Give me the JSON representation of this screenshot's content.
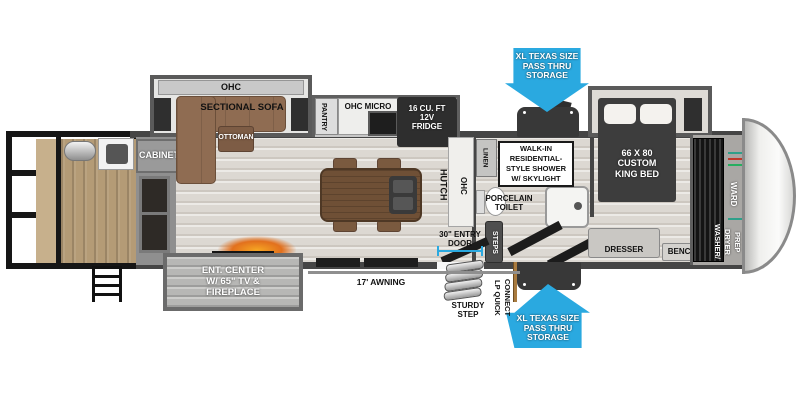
{
  "colors": {
    "arrow_blue": "#2aa9e0",
    "wall_gray": "#454545",
    "sofa_brown": "#8f6c52",
    "island_brown": "#6f5036",
    "bed_dark": "#3d3d3d",
    "garage_wood": "#b49b76",
    "fireplace_orange": "#e8941a"
  },
  "labels": {
    "ohc_top": "OHC",
    "sectional_sofa": "SECTIONAL SOFA",
    "ottoman": "OTTOMAN",
    "cabinet": "CABINET",
    "pantry": "PANTRY",
    "ohc_micro": "OHC MICRO",
    "fridge": "16 CU. FT\n12V\nFRIDGE",
    "pass_thru_top": "XL TEXAS SIZE\nPASS THRU\nSTORAGE",
    "shower": "WALK-IN\nRESIDENTIAL-\nSTYLE SHOWER\nW/ SKYLIGHT",
    "king_bed": "66 X 80\nCUSTOM\nKING BED",
    "hutch": "HUTCH",
    "ohc_hutch": "OHC",
    "linen": "LINEN",
    "toilet": "PORCELAIN\nTOILET",
    "steps": "STEPS",
    "dresser": "DRESSER",
    "bench": "BENCH",
    "ward": "WARD",
    "washer_dryer": "WASHER/\nDRYER\nPREP",
    "ent_center": "ENT. CENTER\nW/ 65\" TV &\nFIREPLACE",
    "awning": "17' AWNING",
    "entry_door": "30\" ENTRY\nDOOR",
    "sturdy_step": "STURDY\nSTEP",
    "lp_quick": "LP QUICK\nCONNECT",
    "pass_thru_bottom": "XL TEXAS SIZE\nPASS THRU\nSTORAGE"
  }
}
